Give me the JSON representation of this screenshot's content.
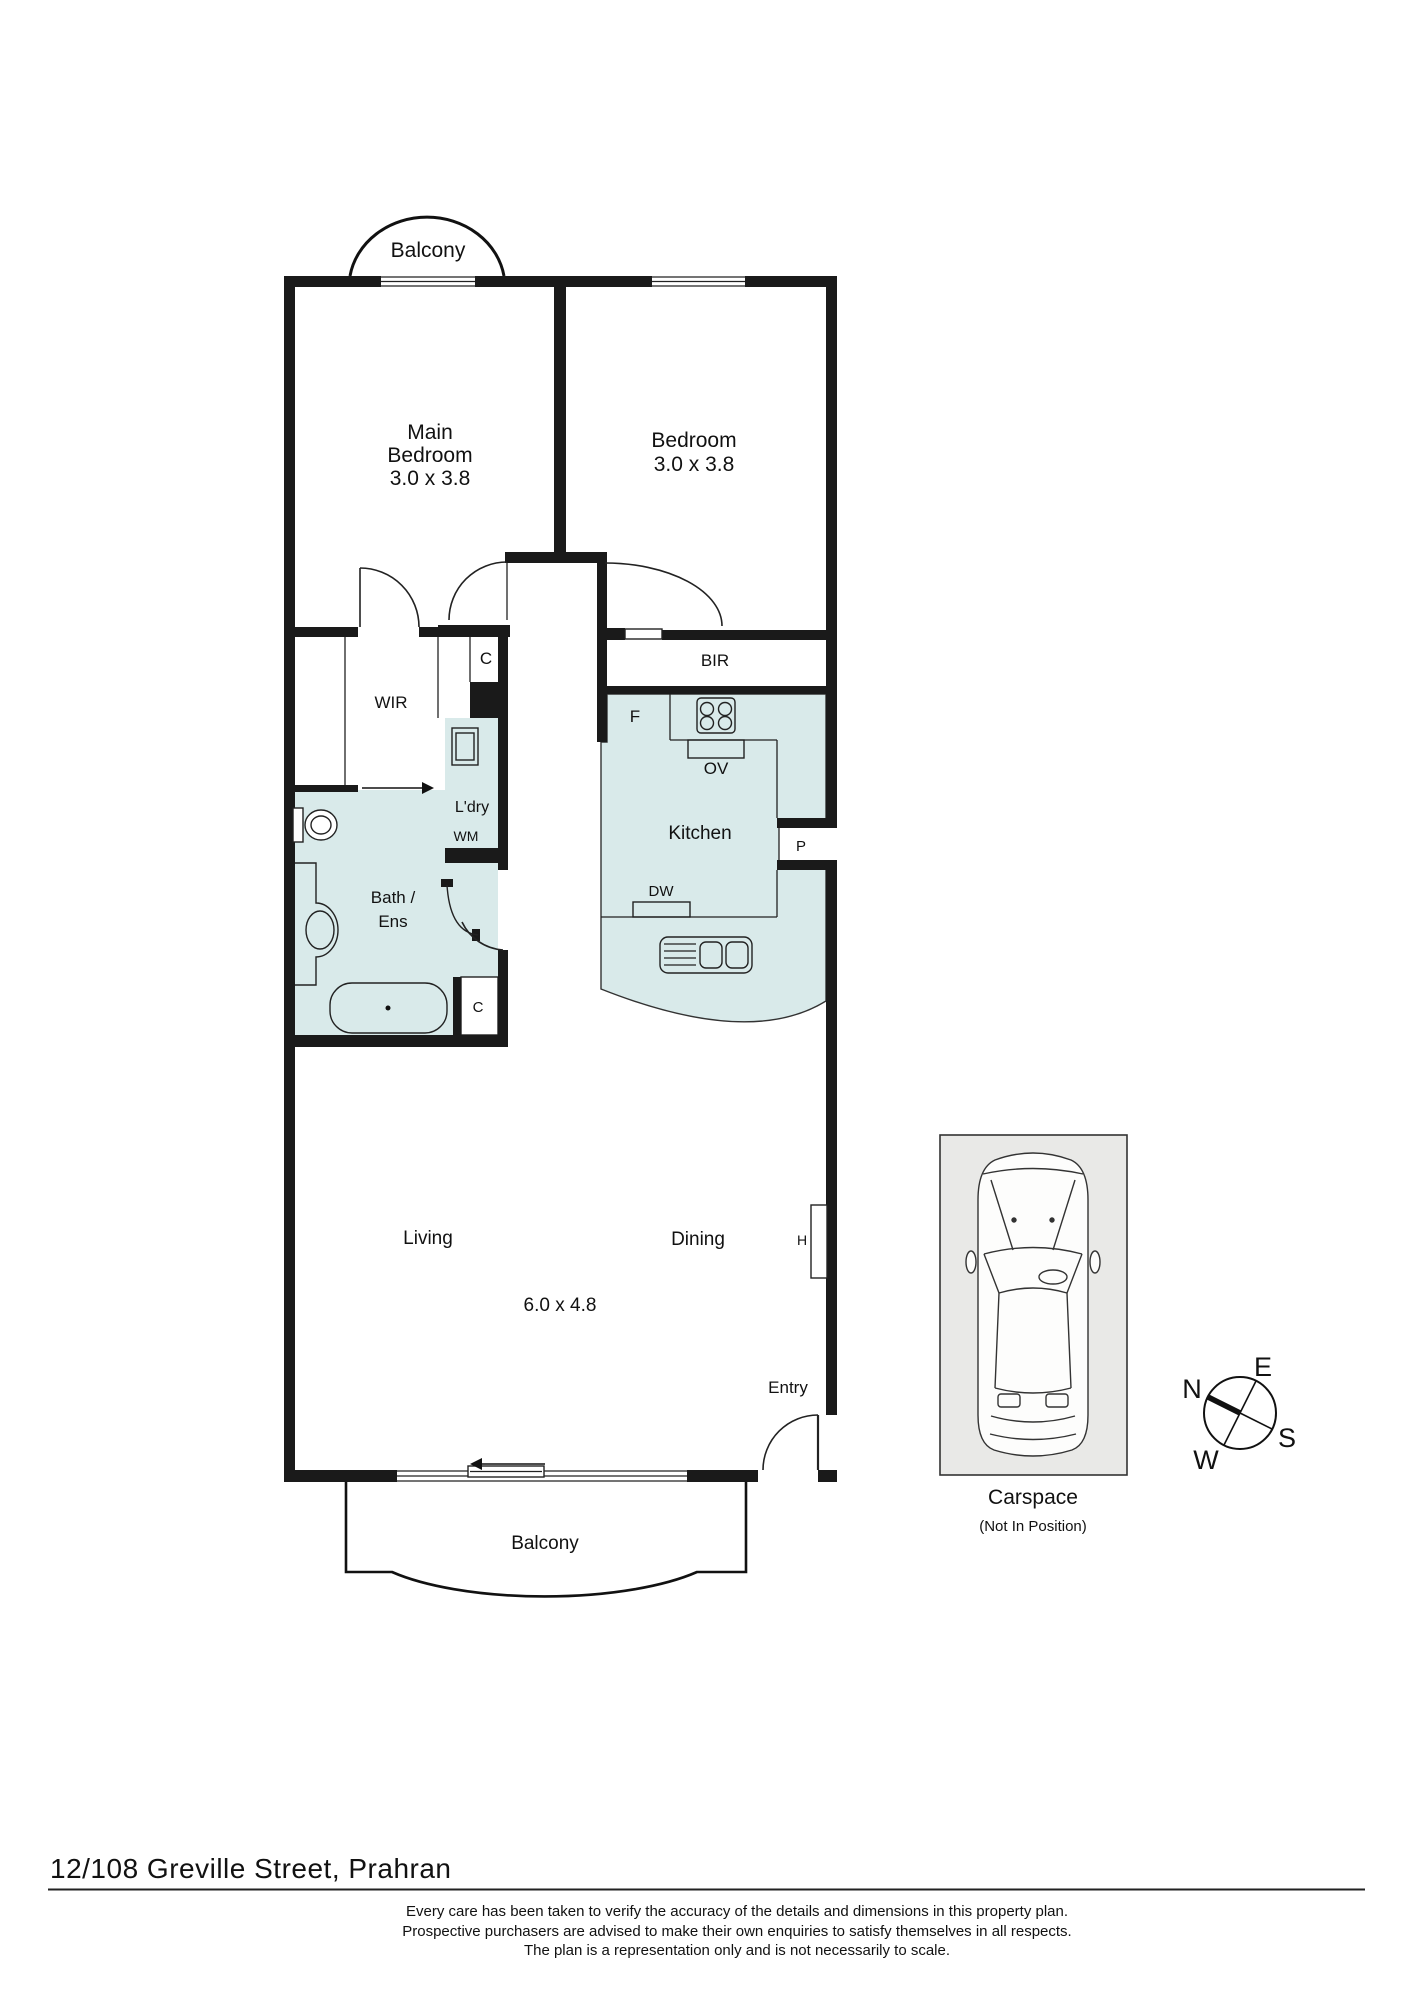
{
  "floorplan": {
    "labels": {
      "balcony_top": "Balcony",
      "main_bedroom_1": "Main",
      "main_bedroom_2": "Bedroom",
      "main_bedroom_dims": "3.0 x 3.8",
      "bedroom2": "Bedroom",
      "bedroom2_dims": "3.0 x 3.8",
      "wir": "WIR",
      "closet_hall": "C",
      "bir": "BIR",
      "fridge": "F",
      "oven": "OV",
      "kitchen": "Kitchen",
      "pantry": "P",
      "dishwasher": "DW",
      "laundry": "L'dry",
      "washing_machine": "WM",
      "bath_1": "Bath /",
      "bath_2": "Ens",
      "closet_bath": "C",
      "living": "Living",
      "dining": "Dining",
      "living_dims": "6.0 x 4.8",
      "hot_water": "H",
      "entry": "Entry",
      "balcony_bottom": "Balcony"
    },
    "carspace": {
      "label": "Carspace",
      "note": "(Not In Position)"
    },
    "compass": {
      "n": "N",
      "e": "E",
      "s": "S",
      "w": "W"
    },
    "footer": {
      "address": "12/108 Greville Street, Prahran",
      "disclaimer_line1": "Every care has been taken to verify the accuracy of the details and dimensions in this property plan.",
      "disclaimer_line2": "Prospective purchasers are advised to make their own enquiries to satisfy themselves in all respects.",
      "disclaimer_line3": "The plan is a representation only and is not necessarily to scale."
    },
    "colors": {
      "wall": "#1a1a1a",
      "wet_area": "#d9eaea",
      "carspace_bg": "#e9e9e7"
    }
  }
}
